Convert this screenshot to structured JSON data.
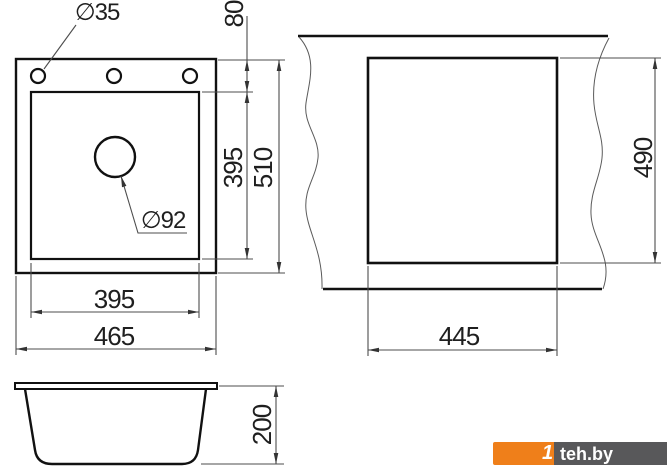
{
  "drawing": {
    "top_view": {
      "hole_diameter": "∅35",
      "drain_diameter": "∅92",
      "rim_offset": "80",
      "bowl_width": "395",
      "bowl_length": "395",
      "overall_width": "465",
      "overall_length": "510"
    },
    "cutout_view": {
      "cutout_width": "445",
      "cutout_length": "490"
    },
    "side_view": {
      "bowl_depth": "200"
    }
  },
  "watermark": {
    "mark": "1",
    "text": "teh.by",
    "accent_color": "#ef7f1a",
    "panel_color": "#58585a"
  },
  "colors": {
    "background": "#ffffff",
    "object_line": "#111111",
    "dimension_line": "#4d4d4d",
    "text": "#1f1f1f"
  }
}
